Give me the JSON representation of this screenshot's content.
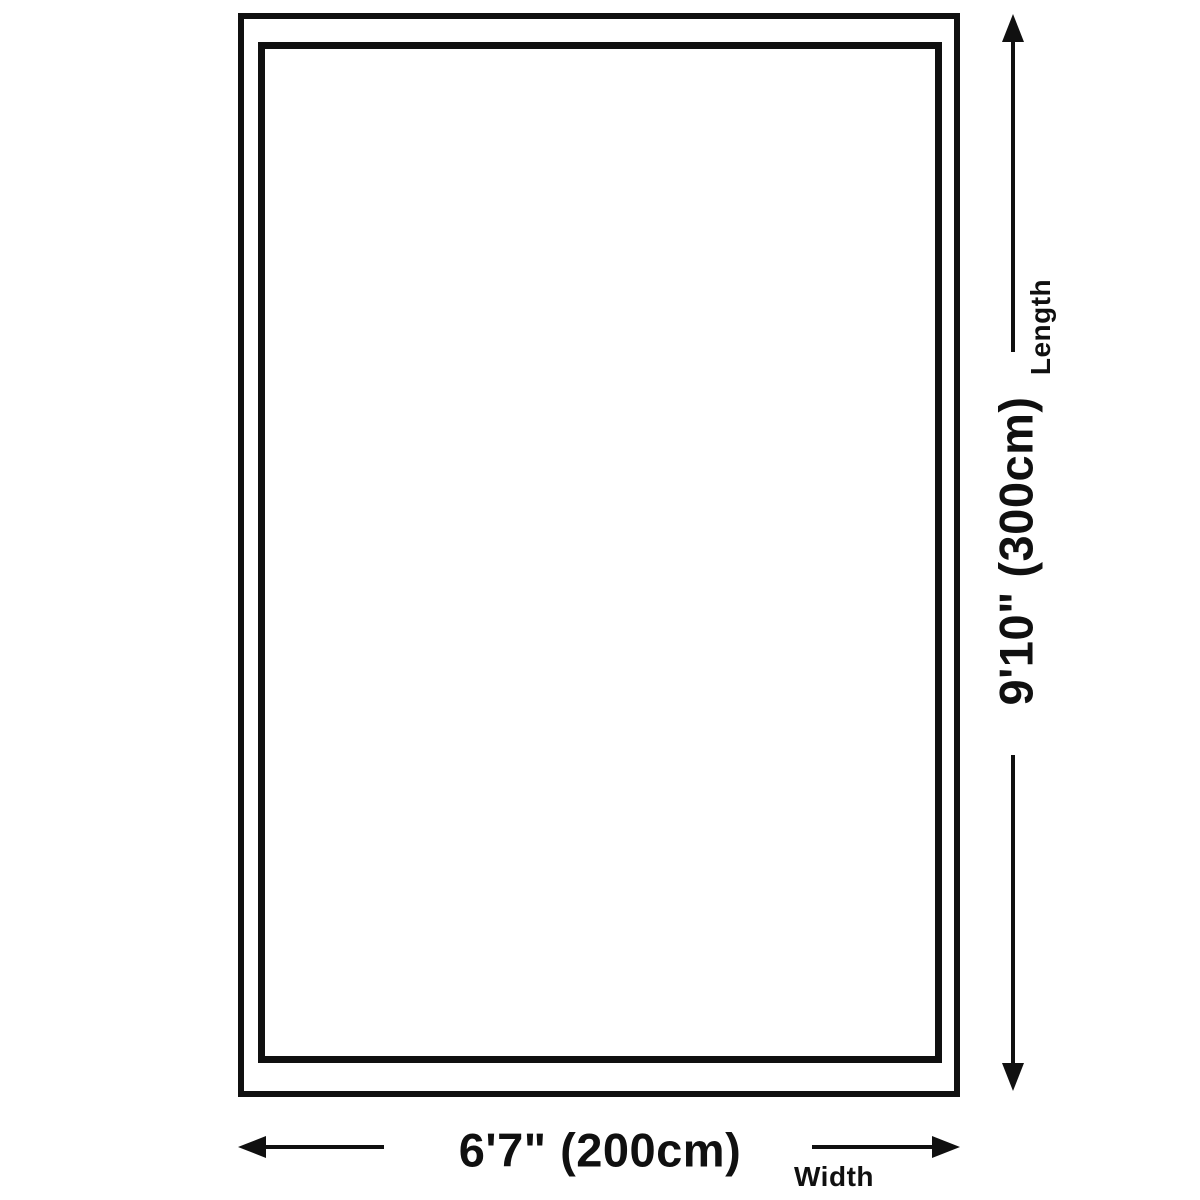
{
  "diagram": {
    "length": {
      "label": "Length",
      "value": "9'10\" (300cm)"
    },
    "width": {
      "label": "Width",
      "value": "6'7\" (200cm)"
    }
  },
  "icons": {
    "length_up_arrow": "arrow-up",
    "length_down_arrow": "arrow-down",
    "width_left_arrow": "arrow-left",
    "width_right_arrow": "arrow-right"
  },
  "colors": {
    "line": "#101010",
    "background": "#ffffff"
  }
}
